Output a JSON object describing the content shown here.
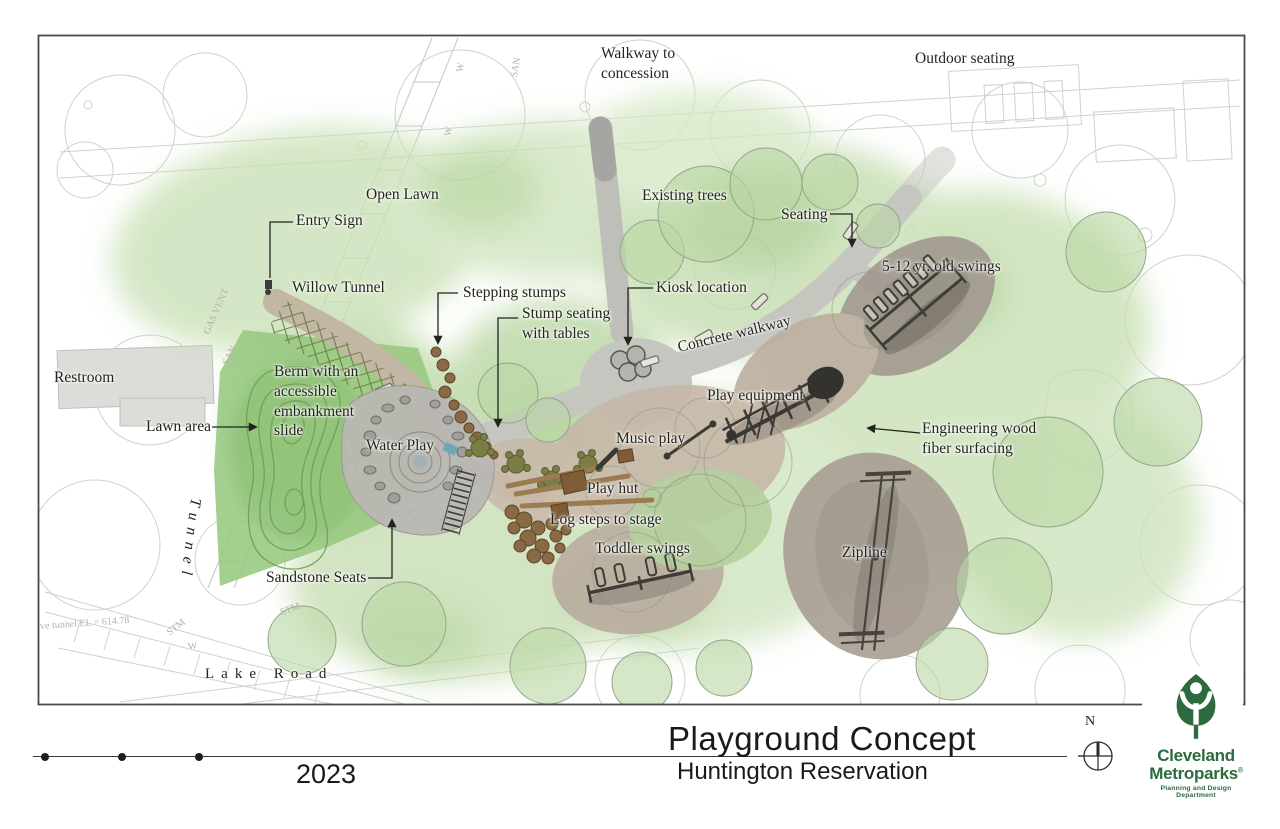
{
  "plan": {
    "labels": {
      "walkway_concession": "Walkway to\nconcession",
      "outdoor_seating": "Outdoor seating",
      "open_lawn": "Open Lawn",
      "entry_sign": "Entry Sign",
      "willow_tunnel": "Willow Tunnel",
      "existing_trees": "Existing trees",
      "seating": "Seating",
      "swings_5_12": "5-12 yr. old swings",
      "stepping_stumps": "Stepping stumps",
      "stump_seating": "Stump seating\nwith tables",
      "kiosk_location": "Kiosk location",
      "concrete_walkway": "Concrete walkway",
      "restroom": "Restroom",
      "berm": "Berm with an\naccessible\nembankment\nslide",
      "lawn_area": "Lawn area",
      "water_play": "Water Play",
      "music_play": "Music play",
      "play_equipment": "Play equipment",
      "wood_fiber": "Engineering wood\nfiber surfacing",
      "play_hut": "Play hut",
      "log_steps": "Log steps to stage",
      "toddler_swings": "Toddler swings",
      "zipline": "Zipline",
      "sandstone_seats": "Sandstone Seats",
      "tunnel": "Tunnel",
      "lake_road": "Lake Road"
    },
    "survey": {
      "tunnel_el": "ve tunnel EL = 614.78",
      "stm": "STM",
      "w": "W",
      "san": "SAN",
      "gas_vent": "GAS VENT"
    }
  },
  "titleblock": {
    "year": "2023",
    "title": "Playground Concept",
    "subtitle": "Huntington Reservation",
    "north": "N"
  },
  "logo": {
    "name_line1": "Cleveland",
    "name_line2": "Metroparks",
    "registered": "®",
    "department": "Planning and Design Department"
  },
  "colors": {
    "logo_green": "#2d6a3f",
    "canopy_green": "#c7dfb2",
    "lawn_green": "#97c87f",
    "walkway_gray": "#c6c6c0",
    "playground_tan": "#c7b7a8"
  }
}
